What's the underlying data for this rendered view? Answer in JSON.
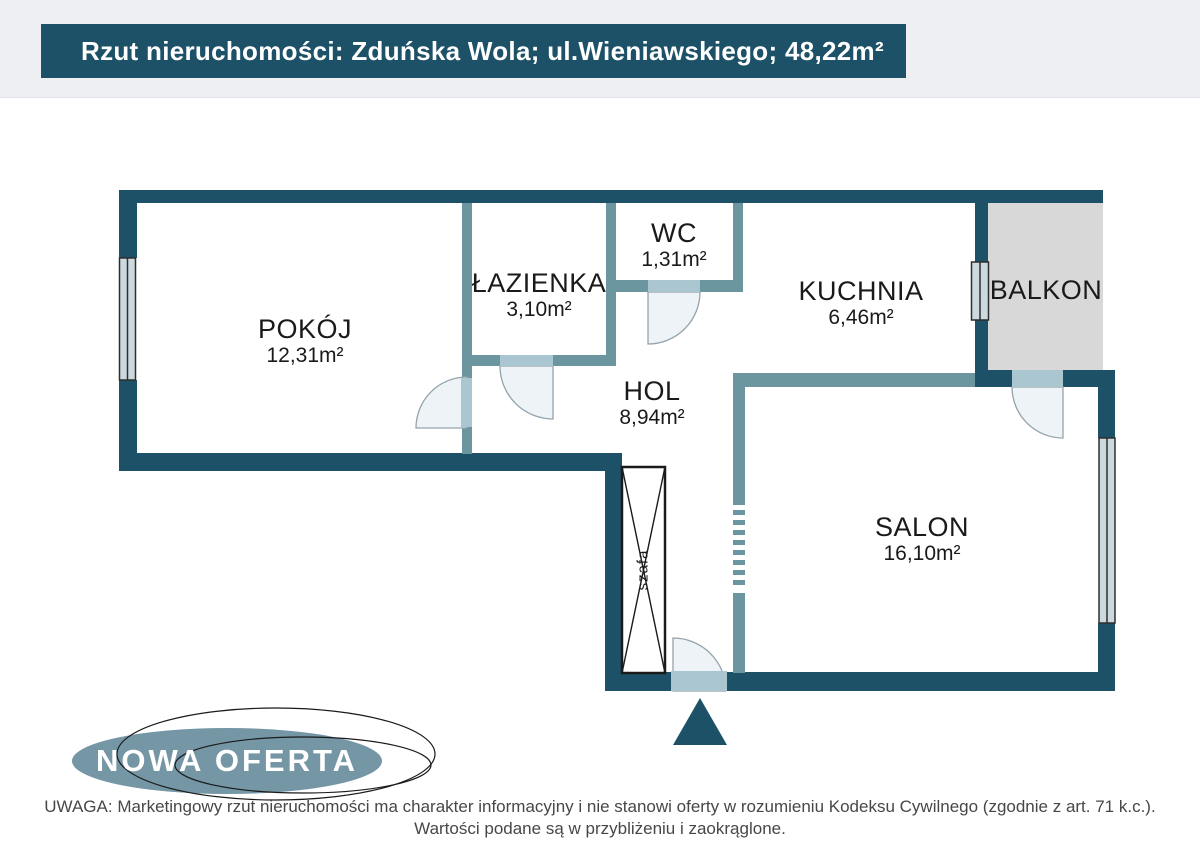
{
  "header": {
    "title": "Rzut nieruchomości: Zduńska Wola; ul.Wieniawskiego; 48,22m²"
  },
  "floorplan": {
    "rooms": [
      {
        "id": "pokoj",
        "name": "POKÓJ",
        "area": "12,31m²"
      },
      {
        "id": "lazienka",
        "name": "ŁAZIENKA",
        "area": "3,10m²"
      },
      {
        "id": "wc",
        "name": "WC",
        "area": "1,31m²"
      },
      {
        "id": "kuchnia",
        "name": "KUCHNIA",
        "area": "6,46m²"
      },
      {
        "id": "balkon",
        "name": "BALKON",
        "area": ""
      },
      {
        "id": "hol",
        "name": "HOL",
        "area": "8,94m²"
      },
      {
        "id": "salon",
        "name": "SALON",
        "area": "16,10m²"
      }
    ],
    "wardrobe_label": "szafa",
    "colors": {
      "wall_outer": "#1d5168",
      "wall_inner": "#6b96a0",
      "door_leaf": "#aac6d1",
      "door_swing": "#eef3f7",
      "window_fill": "#ccdae0",
      "balcony_fill": "#d8d8d8",
      "header_bg": "#1d5168",
      "top_band_bg": "#edeff3",
      "badge_fill": "#7496a5",
      "label_text": "#1a1a1a",
      "footer_text": "#474747"
    }
  },
  "badge": {
    "label": "NOWA OFERTA"
  },
  "footer": {
    "line1": "UWAGA: Marketingowy rzut nieruchomości ma charakter informacyjny i nie stanowi oferty w rozumieniu Kodeksu Cywilnego (zgodnie z art. 71 k.c.).",
    "line2": "Wartości podane są w przybliżeniu i zaokrąglone."
  }
}
